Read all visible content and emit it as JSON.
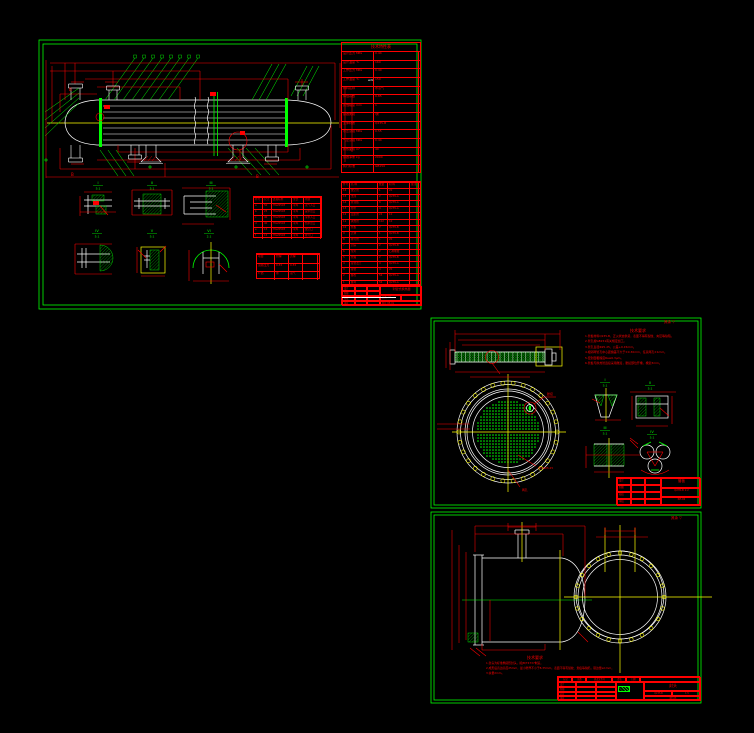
{
  "palette": {
    "red": "#FF0000",
    "green": "#00FF00",
    "yellow": "#FFFF00",
    "white": "#FFFFFF",
    "background": "#000000"
  },
  "sheet1": {
    "section_label": "B",
    "white_note": "wdn",
    "tech_table": {
      "title": "技术特性表",
      "rows": [
        [
          "设计压力 MPa",
          "0.44"
        ],
        [
          "设计温度 ℃",
          "160"
        ],
        [
          "工作压力 MPa",
          "0.40"
        ],
        [
          "工作温度 ℃",
          "150"
        ],
        [
          "物料名称",
          "水蒸气"
        ],
        [
          "焊缝系数",
          "0.85"
        ],
        [
          "腐蚀裕度 mm",
          "1"
        ],
        [
          "容器类别",
          "Ⅰ类"
        ],
        [
          "主体材质",
          "Q235-B"
        ],
        [
          "水压试验 MPa",
          "0.55"
        ],
        [
          "气密试验 MPa",
          "0.44"
        ],
        [
          "换热面积 m²",
          "40"
        ],
        [
          "容器净重 kg",
          "2000"
        ],
        [
          "执行标准",
          "GB150"
        ]
      ]
    },
    "bom": {
      "header": [
        "件号",
        "名  称",
        "数量",
        "材 料",
        "备注"
      ],
      "rows": [
        [
          "16",
          "放空管",
          "1",
          "20",
          ""
        ],
        [
          "15",
          "支座",
          "2",
          "Q235-A",
          ""
        ],
        [
          "14",
          "折流板",
          "8",
          "Q235-A",
          ""
        ],
        [
          "13",
          "拉杆",
          "4",
          "Q235-A",
          ""
        ],
        [
          "12",
          "定距管",
          "24",
          "10",
          ""
        ],
        [
          "11",
          "换热管",
          "102",
          "10",
          ""
        ],
        [
          "10",
          "管板",
          "2",
          "Q235-B",
          ""
        ],
        [
          "9",
          "壳体",
          "1",
          "Q235-B",
          ""
        ],
        [
          "8",
          "排污管",
          "1",
          "20",
          ""
        ],
        [
          "7",
          "封头",
          "2",
          "Q235-B",
          ""
        ],
        [
          "6",
          "垫片",
          "2",
          "石棉橡胶",
          ""
        ],
        [
          "5",
          "管箱",
          "2",
          "Q235-B",
          ""
        ],
        [
          "4",
          "接管法兰",
          "4",
          "Q235-A",
          ""
        ],
        [
          "3",
          "接管",
          "4",
          "20",
          ""
        ],
        [
          "2",
          "螺栓",
          "56",
          "Q235-A",
          ""
        ],
        [
          "1",
          "螺母",
          "56",
          "Q235-A",
          ""
        ]
      ]
    },
    "nozzle_table": {
      "header": [
        "符号",
        "尺寸",
        "连接标准",
        "型式",
        "用途"
      ],
      "rows": [
        [
          "a",
          "50",
          "HG20593",
          "平焊",
          "蒸气入口"
        ],
        [
          "b",
          "25",
          "HG20593",
          "平焊",
          "凝水出口"
        ],
        [
          "c",
          "40",
          "HG20593",
          "平焊",
          "冷水入口"
        ],
        [
          "d",
          "40",
          "HG20593",
          "平焊",
          "热水出口"
        ],
        [
          "e",
          "15",
          "HG20593",
          "平焊",
          "放空口"
        ],
        [
          "f",
          "15",
          "HG20593",
          "平焊",
          "排污口"
        ]
      ]
    },
    "test_table": {
      "rows": [
        [
          "项目",
          "管程",
          "壳程",
          ""
        ],
        [
          "试验压力",
          "0.55",
          "0.55",
          ""
        ],
        [
          "介质",
          "水",
          "蒸气",
          ""
        ]
      ]
    },
    "details": [
      {
        "label": "I",
        "scale": "5:1"
      },
      {
        "label": "II",
        "scale": "5:1"
      },
      {
        "label": "III",
        "scale": "5:1"
      },
      {
        "label": "IV",
        "scale": "5:1"
      },
      {
        "label": "V",
        "scale": "5:1"
      },
      {
        "label": "VI",
        "scale": "2:1"
      }
    ],
    "title_block": {
      "rows": [
        "设计",
        "制图",
        "校核",
        "审核"
      ],
      "name": "列管式换热器",
      "scale_label": "比例",
      "scale": "1:5",
      "no_label": "图号",
      "no": "RE-01"
    }
  },
  "sheet2": {
    "finish_mark": "其余 ▽",
    "notes": {
      "title": "技术要求",
      "lines": [
        "1.管板材料Q235-B，正火状态供货，表面不得有裂纹、夹层等缺陷。",
        "2.管孔按GB151有关规定加工。",
        "3.管孔直径Φ25.25，公差+0.15mm。",
        "4.相邻两管孔中心距偏差不大于±0.30mm，任意两孔±1mm。",
        "5.密封面粗糙度Ra≤6.3μm。",
        "6.管板与换热管连接采用胀接，胀接部位开槽，槽宽3mm。"
      ]
    },
    "labels": {
      "expand": "胀接",
      "tube_hole": "HX-Φ25.25",
      "two_holes": "两孔"
    },
    "details": [
      {
        "label": "I",
        "scale": "5:1"
      },
      {
        "label": "II",
        "scale": "5:1"
      },
      {
        "label": "III",
        "scale": "5:1"
      },
      {
        "label": "IV",
        "scale": "5:1"
      }
    ],
    "title_block": {
      "rows": [
        "设计",
        "制图",
        "校核",
        "审核"
      ],
      "name": "管板",
      "material": "Q235-B",
      "scale": "1:2",
      "no": "RE-02"
    }
  },
  "sheet3": {
    "finish_mark": "其余 ▽",
    "notes": {
      "title": "技术要求",
      "lines": [
        "1.封头为标准椭圆形封头，按JB/T4737制造。",
        "2.成形后直边高度25mm，最小壁厚不小于8.35mm，表面不得有裂纹、划痕等缺陷，错边量≤1mm。",
        "3.余量2mm。"
      ]
    },
    "title_block": {
      "strip": [
        "标记",
        "处数",
        "更改文件号",
        "签名",
        "日期"
      ],
      "rows": [
        "设计",
        "制图",
        "校核",
        "审核"
      ],
      "name": "封头",
      "material": "Q235-B",
      "scale": "1:5",
      "no": "RE-03"
    }
  }
}
